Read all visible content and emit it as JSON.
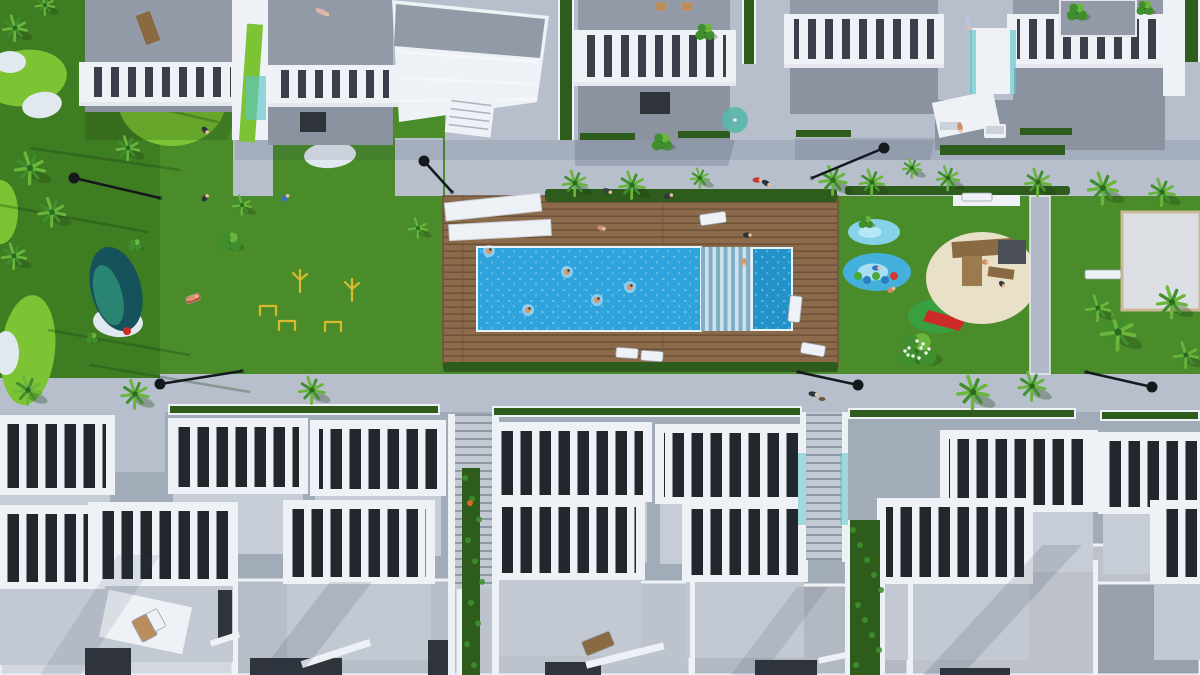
{
  "scene": {
    "description": "Aerial top-down 3D architectural render of a white residential complex: two rows of townhouses with slatted roof pergolas flanking a central landscaped garden with a large rectangular swimming pool on a wooden deck, kids pool, playgrounds, mini golf green, palm trees, lawns and walkways",
    "colors": {
      "pavement": "#b6bfcb",
      "pavementDark": "#a2abb8",
      "grass": "#4a8c2a",
      "grassDark": "#3f7d22",
      "grassLight": "#7cc433",
      "sand": "#e2e8ef",
      "beach": "#e9e0c8",
      "poolBlue": "#2ea3dc",
      "poolDark": "#2292c9",
      "deck": "#8b6b4b",
      "deckDark": "#6f5338",
      "roofGray": "#939aa7",
      "roofLight": "#c7cdd6",
      "terrace": "#8b92a0",
      "white": "#eef1f6",
      "slatDark": "#39404a",
      "slatDarkB": "#22272e",
      "hedge": "#2d5c1d",
      "palm1": "#3f8f2f",
      "palm2": "#6ab63c",
      "palmDark": "#2b6b20",
      "teal": "#5fc4c9",
      "pond1": "#16525c",
      "pond2": "#2c8a74",
      "lamp": "#15181c",
      "wood": "#8a6a42",
      "yellow": "#d9b92e",
      "red": "#cc2a26"
    }
  },
  "top_buildings": [
    [
      85,
      150,
      62,
      62,
      40,
      10
    ],
    [
      268,
      125,
      65,
      65,
      38,
      42
    ],
    [
      578,
      152,
      30,
      30,
      52,
      58
    ],
    [
      790,
      148,
      14,
      14,
      50,
      50
    ],
    [
      1013,
      152,
      14,
      14,
      50,
      50
    ]
  ],
  "angled_building": {
    "outline": "392,0 549,16 537,102 399,122",
    "roof": "396,4 545,19 540,58 394,46",
    "ridges": [
      [
        399,
        52,
        538,
        62
      ],
      [
        400,
        78,
        537,
        84
      ],
      [
        401,
        101,
        536,
        99
      ]
    ],
    "stairs": [
      447,
      95,
      46,
      40,
      7
    ]
  },
  "top_extras": {
    "white_walls": [
      [
        232,
        0,
        36,
        140,
        0
      ],
      [
        1163,
        0,
        22,
        96,
        0
      ],
      [
        935,
        96,
        62,
        36,
        -12
      ],
      [
        972,
        28,
        42,
        66,
        0
      ],
      [
        953,
        190,
        67,
        16,
        0
      ]
    ],
    "green_ramps": [
      [
        243,
        24,
        16,
        118,
        4
      ]
    ],
    "green_strips": [
      [
        560,
        0,
        12,
        140
      ],
      [
        744,
        0,
        10,
        64
      ],
      [
        1185,
        0,
        13,
        62
      ]
    ],
    "teal_glass": [
      [
        246,
        76,
        20,
        44
      ],
      [
        970,
        30,
        6,
        64
      ],
      [
        1010,
        30,
        6,
        64
      ]
    ],
    "gray_roofs": [
      [
        1060,
        0,
        76,
        36
      ]
    ],
    "terrace_band": [
      935,
      100,
      230,
      50
    ],
    "terrace_planter": [
      940,
      145,
      125,
      10
    ],
    "doorways": [
      [
        300,
        112,
        26,
        20
      ],
      [
        640,
        92,
        30,
        22
      ]
    ],
    "hedge_strips": [
      [
        580,
        133,
        55,
        7
      ],
      [
        678,
        131,
        52,
        7
      ],
      [
        796,
        130,
        55,
        7
      ],
      [
        1020,
        128,
        52,
        7
      ]
    ]
  },
  "deck_area": {
    "hedge_top": [
      545,
      189,
      292,
      13
    ],
    "hedge_right": [
      845,
      186,
      225,
      9
    ],
    "hedge_bottom": [
      443,
      362,
      395,
      10
    ],
    "canopies": [
      [
        445,
        198,
        96,
        18,
        -6
      ],
      [
        449,
        222,
        102,
        16,
        -3
      ]
    ]
  },
  "pool": {
    "swimmers": [
      [
        567,
        272
      ],
      [
        630,
        287
      ],
      [
        528,
        310
      ],
      [
        597,
        300
      ],
      [
        489,
        251
      ]
    ]
  },
  "bottom_row1": [
    [
      -35,
      415,
      150,
      80
    ],
    [
      168,
      418,
      140,
      76
    ],
    [
      310,
      420,
      136,
      76
    ],
    [
      488,
      422,
      164,
      80
    ],
    [
      655,
      424,
      153,
      80
    ],
    [
      940,
      430,
      158,
      82
    ],
    [
      1098,
      432,
      130,
      82
    ]
  ],
  "bottom_row2": [
    [
      -45,
      505,
      150,
      84
    ],
    [
      88,
      502,
      150,
      84
    ],
    [
      283,
      500,
      152,
      84
    ],
    [
      493,
      498,
      152,
      82
    ],
    [
      682,
      500,
      126,
      82
    ],
    [
      877,
      498,
      156,
      86
    ],
    [
      1150,
      500,
      100,
      84
    ]
  ],
  "row3_roofs": [
    [
      0,
      553,
      233,
      122,
      "#d3d8e0"
    ],
    [
      235,
      580,
      223,
      95,
      "#b8bec8"
    ],
    [
      460,
      582,
      230,
      93,
      "#bdc3cc"
    ],
    [
      692,
      585,
      216,
      90,
      "#b3b9c3"
    ],
    [
      910,
      545,
      290,
      130,
      "#bcc1ca"
    ],
    [
      1095,
      583,
      105,
      92,
      "#99a0ac"
    ]
  ],
  "separators": [
    [
      233,
      553,
      5,
      122
    ],
    [
      458,
      580,
      5,
      95
    ],
    [
      690,
      582,
      5,
      93
    ],
    [
      908,
      545,
      5,
      130
    ],
    [
      1093,
      560,
      5,
      115
    ]
  ],
  "dark_openings": [
    [
      85,
      648,
      46,
      27
    ],
    [
      250,
      658,
      92,
      17
    ],
    [
      545,
      662,
      56,
      13
    ],
    [
      755,
      660,
      62,
      15
    ],
    [
      940,
      668,
      70,
      7
    ],
    [
      428,
      640,
      20,
      35
    ],
    [
      218,
      590,
      14,
      48
    ]
  ],
  "white_railings": [
    [
      300,
      650,
      72,
      7,
      -18
    ],
    [
      210,
      636,
      30,
      6,
      -18
    ],
    [
      585,
      652,
      80,
      7,
      -14
    ],
    [
      818,
      652,
      56,
      6,
      -12
    ],
    [
      103,
      598,
      85,
      48,
      12
    ]
  ],
  "stairwells": {
    "s1": {
      "walls": [
        [
          448,
          414,
          7,
          261
        ],
        [
          492,
          414,
          7,
          261
        ]
      ],
      "tread": [
        455,
        414,
        37,
        175
      ],
      "green": [
        462,
        468,
        18,
        207
      ],
      "flower": [
        470,
        503
      ]
    },
    "s2": {
      "walls": [
        [
          800,
          412,
          6,
          150
        ],
        [
          842,
          412,
          6,
          150
        ],
        [
          845,
          520,
          5,
          155
        ],
        [
          880,
          520,
          5,
          155
        ]
      ],
      "tread": [
        806,
        412,
        36,
        148
      ],
      "green": [
        850,
        520,
        30,
        155
      ],
      "glass": [
        [
          798,
          453,
          8,
          72
        ],
        [
          840,
          453,
          8,
          72
        ]
      ]
    }
  },
  "landscape": {
    "golf_greens": [
      [
        25,
        78,
        42,
        28,
        -8
      ],
      [
        172,
        100,
        54,
        46,
        0
      ],
      [
        28,
        350,
        27,
        55,
        6
      ],
      [
        0,
        212,
        18,
        32,
        0
      ]
    ],
    "sand_patches": [
      [
        10,
        62,
        16,
        11,
        0
      ],
      [
        42,
        105,
        20,
        13,
        -10
      ],
      [
        118,
        322,
        25,
        15,
        4
      ],
      [
        6,
        353,
        13,
        22,
        0
      ],
      [
        330,
        155,
        26,
        13,
        -4
      ]
    ],
    "pond": {
      "cx": 116,
      "cy": 289,
      "rx": 25,
      "ry": 43,
      "rot": -15
    },
    "trunk_shadows": [
      [
        0,
        205,
        148,
        232
      ],
      [
        30,
        148,
        180,
        170
      ],
      [
        48,
        330,
        190,
        355
      ],
      [
        90,
        365,
        250,
        392
      ],
      [
        86,
        92,
        218,
        122
      ]
    ],
    "road_planters": [
      [
        168,
        404,
        272
      ],
      [
        492,
        406,
        310
      ],
      [
        848,
        408,
        228
      ],
      [
        1100,
        410,
        100
      ]
    ],
    "splash_pads": [
      [
        874,
        232,
        26,
        13,
        "#86d2e8"
      ],
      [
        877,
        272,
        34,
        19,
        "#46b0dc"
      ]
    ],
    "caterpillar": {
      "x": 858,
      "y": 277,
      "n": 5
    },
    "minigolf": {
      "cx": 938,
      "cy": 316,
      "rx": 30,
      "ry": 17,
      "slide": "928,310 966,320 959,331 923,321"
    },
    "sand_blob": {
      "cx": 982,
      "cy": 278,
      "rx": 56,
      "ry": 46
    },
    "play_structure": [
      [
        952,
        240,
        62,
        16,
        -4,
        "#8a6a42"
      ],
      [
        962,
        256,
        20,
        30,
        0,
        "#9a7a4e"
      ],
      [
        998,
        240,
        28,
        24,
        0,
        "#4a4f57"
      ],
      [
        988,
        268,
        26,
        10,
        8,
        "#8a6a42"
      ]
    ],
    "court": {
      "x": 1122,
      "y": 212,
      "w": 78,
      "h": 98
    },
    "wall": [
      1030,
      196,
      20,
      178
    ],
    "playground_items": [
      [
        300,
        282,
        "palm"
      ],
      [
        352,
        291,
        "palm"
      ],
      [
        287,
        321,
        "bars"
      ],
      [
        333,
        322,
        "bars"
      ],
      [
        268,
        306,
        "bars"
      ]
    ],
    "ball": [
      127,
      331
    ]
  },
  "furniture": {
    "loungers": [
      [
        700,
        213,
        26,
        11,
        -8,
        "#eef1f6"
      ],
      [
        789,
        296,
        12,
        26,
        6,
        "#eef1f6"
      ],
      [
        801,
        344,
        24,
        11,
        10,
        "#eef1f6"
      ],
      [
        616,
        348,
        22,
        10,
        4,
        "#eef1f6"
      ],
      [
        641,
        351,
        22,
        10,
        4,
        "#eef1f6"
      ],
      [
        140,
        12,
        16,
        32,
        -20,
        "#8a6a42"
      ],
      [
        655,
        2,
        12,
        9,
        0,
        "#b98d5e"
      ],
      [
        681,
        2,
        12,
        9,
        0,
        "#b98d5e"
      ],
      [
        583,
        636,
        30,
        15,
        -22,
        "#8a6a42"
      ],
      [
        136,
        616,
        17,
        24,
        -28,
        "#b98d5e"
      ],
      [
        150,
        610,
        12,
        20,
        -28,
        "#eef1f6"
      ],
      [
        186,
        295,
        14,
        7,
        -20,
        "#cc3a30"
      ]
    ],
    "sofas": [
      [
        938,
        120,
        22,
        14
      ],
      [
        984,
        124,
        22,
        14
      ]
    ],
    "benches": [
      [
        1085,
        270,
        36,
        9
      ],
      [
        962,
        193,
        30,
        8
      ]
    ],
    "parasol": [
      735,
      120,
      13
    ]
  },
  "vegetation": {
    "palms": [
      [
        30,
        168,
        1.1
      ],
      [
        52,
        212,
        1.0
      ],
      [
        14,
        256,
        0.9
      ],
      [
        128,
        148,
        0.85
      ],
      [
        242,
        205,
        0.7
      ],
      [
        418,
        228,
        0.7
      ],
      [
        575,
        183,
        0.9
      ],
      [
        632,
        185,
        0.95
      ],
      [
        700,
        178,
        0.7
      ],
      [
        833,
        180,
        1.0
      ],
      [
        872,
        182,
        0.9
      ],
      [
        948,
        178,
        0.85
      ],
      [
        1038,
        182,
        0.95
      ],
      [
        1103,
        188,
        1.1
      ],
      [
        1162,
        192,
        0.95
      ],
      [
        28,
        390,
        1.0
      ],
      [
        135,
        394,
        1.0
      ],
      [
        312,
        390,
        0.95
      ],
      [
        973,
        392,
        1.15
      ],
      [
        1032,
        386,
        1.0
      ],
      [
        1118,
        332,
        1.25
      ],
      [
        1172,
        302,
        1.1
      ],
      [
        1098,
        308,
        0.9
      ],
      [
        1186,
        355,
        0.9
      ],
      [
        15,
        28,
        0.9
      ],
      [
        45,
        5,
        0.7
      ],
      [
        912,
        168,
        0.7
      ]
    ],
    "bushes": [
      [
        230,
        242,
        0.9
      ],
      [
        662,
        142,
        0.85
      ],
      [
        705,
        32,
        0.8
      ],
      [
        1077,
        12,
        0.85
      ],
      [
        1145,
        8,
        0.7
      ],
      [
        866,
        222,
        0.6
      ],
      [
        135,
        245,
        0.55
      ],
      [
        92,
        338,
        0.5
      ]
    ],
    "flower_bushes": [
      [
        917,
        350,
        1.0
      ]
    ]
  },
  "people": [
    [
      607,
      191,
      "#3a3f46",
      20,
      9
    ],
    [
      668,
      196,
      "#33383f",
      -15,
      9
    ],
    [
      757,
      180,
      "#c23a32",
      0,
      9
    ],
    [
      766,
      183,
      "#2e3338",
      30,
      9
    ],
    [
      960,
      127,
      "#c98f6a",
      80,
      10
    ],
    [
      813,
      394,
      "#2e3338",
      10,
      9
    ],
    [
      891,
      290,
      "#d08a60",
      -30,
      8
    ],
    [
      876,
      268,
      "#3a6fc2",
      0,
      8
    ],
    [
      285,
      198,
      "#3a6fc2",
      -40,
      9
    ],
    [
      192,
      298,
      "#d8956a",
      -20,
      12
    ],
    [
      322,
      12,
      "#e0b4a8",
      25,
      14
    ],
    [
      968,
      22,
      "#b9c3e2",
      78,
      14
    ],
    [
      985,
      262,
      "#d08a60",
      0,
      7
    ],
    [
      1002,
      284,
      "#34393f",
      45,
      7
    ],
    [
      744,
      262,
      "#d8956a",
      90,
      8
    ],
    [
      601,
      228,
      "#c98f6a",
      15,
      8
    ],
    [
      747,
      235,
      "#2e3338",
      0,
      8
    ],
    [
      205,
      130,
      "#2e3338",
      45,
      8
    ],
    [
      205,
      198,
      "#2e3338",
      -45,
      8
    ]
  ],
  "dog": [
    822,
    399
  ],
  "lamps": [
    [
      74,
      178,
      160,
      198
    ],
    [
      424,
      161,
      452,
      192
    ],
    [
      884,
      148,
      812,
      178
    ],
    [
      160,
      384,
      242,
      371
    ],
    [
      858,
      385,
      798,
      372
    ],
    [
      1152,
      387,
      1086,
      372
    ]
  ],
  "shadows": [
    [
      "235,140 1200,140 1200,160 235,160",
      0.12
    ],
    [
      "575,140 735,140 728,166 575,166",
      0.18
    ],
    [
      "795,138 935,138 930,160 795,160",
      0.15
    ],
    [
      "85,112 235,112 228,140 85,140",
      0.22,
      "#1d3d12"
    ]
  ],
  "roof_shadows": [
    [
      "330,582 372,582 300,675 258,675",
      0.14
    ],
    [
      "1043,545 1082,545 962,675 923,675",
      0.14
    ],
    [
      "797,587 828,587 762,675 731,675",
      0.12
    ],
    [
      "118,555 160,555 80,675 40,675",
      0.1
    ]
  ]
}
